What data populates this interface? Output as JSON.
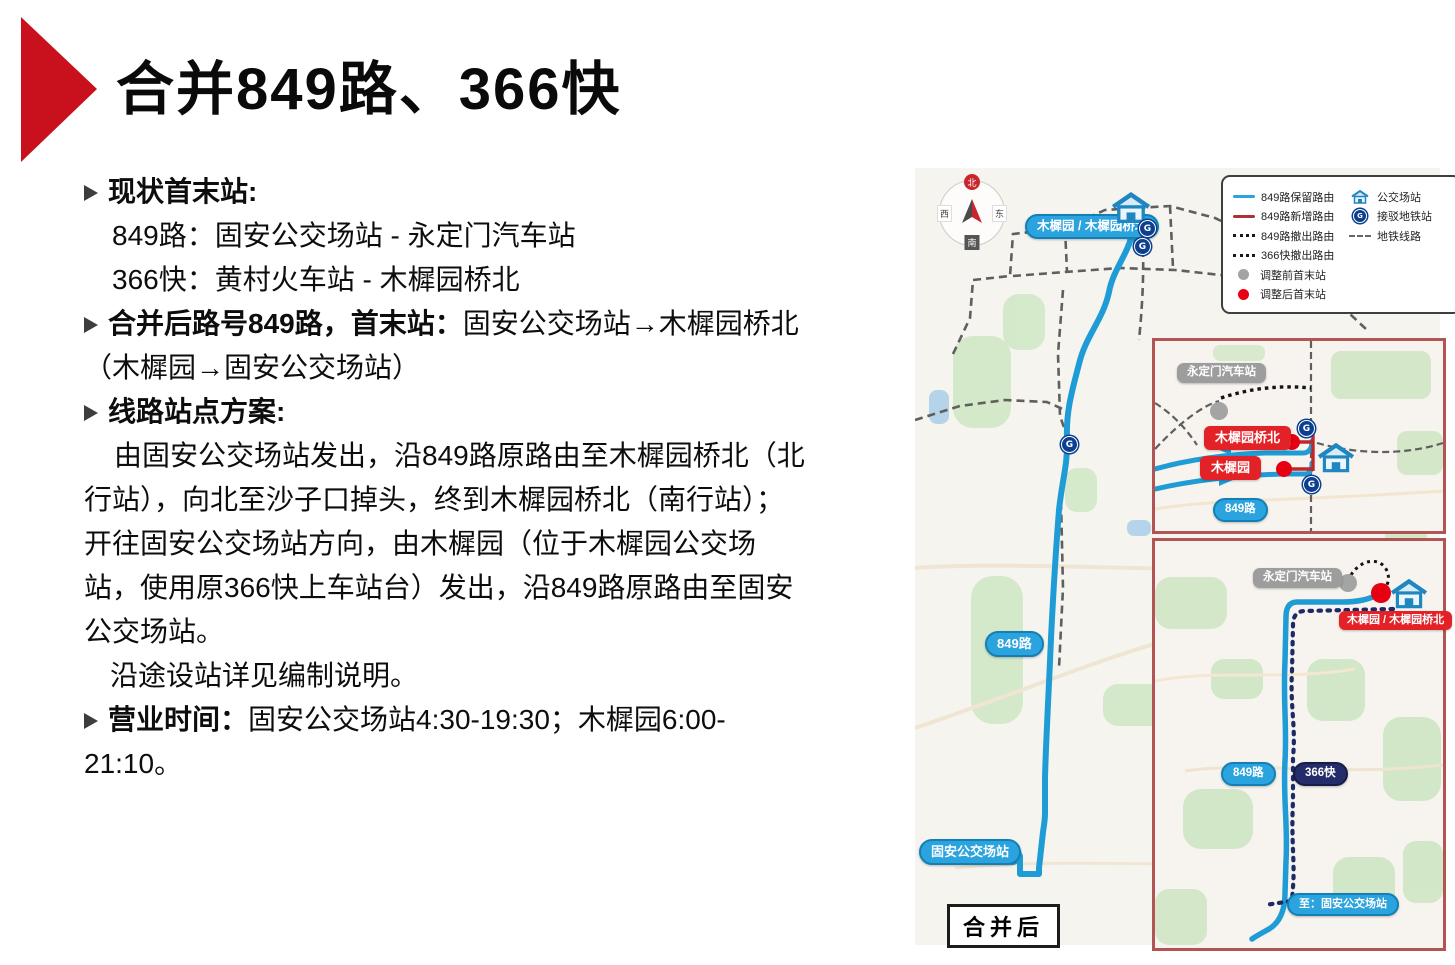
{
  "slide": {
    "title": "合并849路、366快",
    "content": {
      "s1_heading": "现状首末站:",
      "s1_line1": "849路：固安公交场站 - 永定门汽车站",
      "s1_line2": "366快：黄村火车站 - 木樨园桥北",
      "s2_heading": "合并后路号849路，首末站：",
      "s2_text": "固安公交场站→木樨园桥北（木樨园→固安公交场站）",
      "s3_heading": "线路站点方案:",
      "s3_para1": "由固安公交场站发出，沿849路原路由至木樨园桥北（北行站），向北至沙子口掉头，终到木樨园桥北（南行站）；开往固安公交场站方向，由木樨园（位于木樨园公交场站，使用原366快上车站台）发出，沿849路原路由至固安公交场站。",
      "s3_para2": "沿途设站详见编制说明。",
      "s4_heading": "营业时间：",
      "s4_text": "固安公交场站4:30-19:30；木樨园6:00-21:10。"
    }
  },
  "map": {
    "compass": {
      "n": "北",
      "s": "南",
      "e": "东",
      "w": "西"
    },
    "legend": {
      "left": [
        {
          "label": "849路保留路由"
        },
        {
          "label": "849路新增路由"
        },
        {
          "label": "849路撤出路由"
        },
        {
          "label": "366快撤出路由"
        },
        {
          "label": "调整前首末站"
        },
        {
          "label": "调整后首末站"
        }
      ],
      "right": [
        {
          "label": "公交场站"
        },
        {
          "label": "接驳地铁站"
        },
        {
          "label": "地铁线路"
        }
      ]
    },
    "main": {
      "terminal_top": "木樨园 / 木樨园桥北",
      "route_label": "849路",
      "terminal_bottom": "固安公交场站",
      "badge": "合并后"
    },
    "inset1": {
      "yongdingmen": "永定门汽车站",
      "muxiyuan_bridge_north": "木樨园桥北",
      "muxiyuan": "木樨园",
      "route_label": "849路"
    },
    "inset2": {
      "yongdingmen": "永定门汽车站",
      "terminal": "木樨园 / 木樨园桥北",
      "route849": "849路",
      "route366": "366快",
      "to_terminal": "至：固安公交场站"
    },
    "colors": {
      "route_blue": "#2aa3de",
      "route_red": "#b03038",
      "label_red": "#e32227",
      "navy": "#242d69",
      "gray_station": "#9d9d9d",
      "inset_border": "#b15454"
    }
  }
}
